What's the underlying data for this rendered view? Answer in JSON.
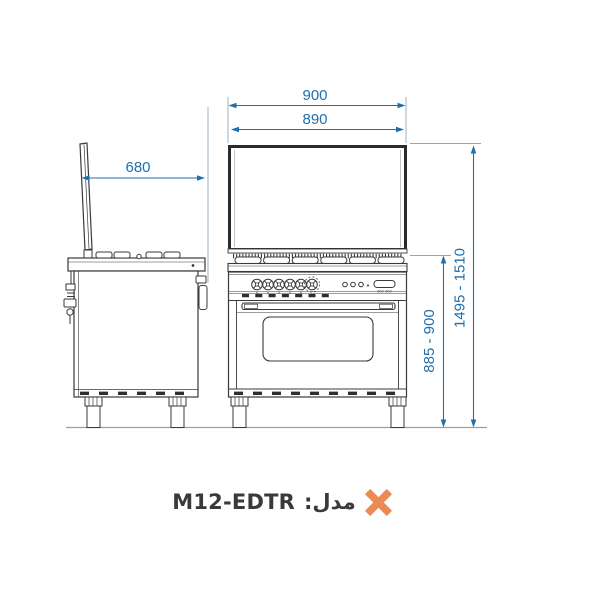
{
  "page": {
    "background": "#ffffff"
  },
  "colors": {
    "dimension_blue": "#1e6fae",
    "extension_gray": "#93a7b8",
    "line_dark": "#3a3a3a",
    "accent_orange": "#ec8a52",
    "ground_gray": "#98a1a8"
  },
  "diagram": {
    "subject": "freestanding range cooker dimension drawing, side and front elevations",
    "dimensions": [
      {
        "id": "width-overall",
        "value": "900"
      },
      {
        "id": "width-glass",
        "value": "890"
      },
      {
        "id": "depth",
        "value": "680"
      },
      {
        "id": "height-cooktop",
        "value": "885 - 900"
      },
      {
        "id": "height-overall",
        "value": "1495 - 1510"
      }
    ],
    "display_text": "000 000"
  },
  "footer": {
    "model_label": "مدل:",
    "model_value": "M12-EDTR"
  }
}
